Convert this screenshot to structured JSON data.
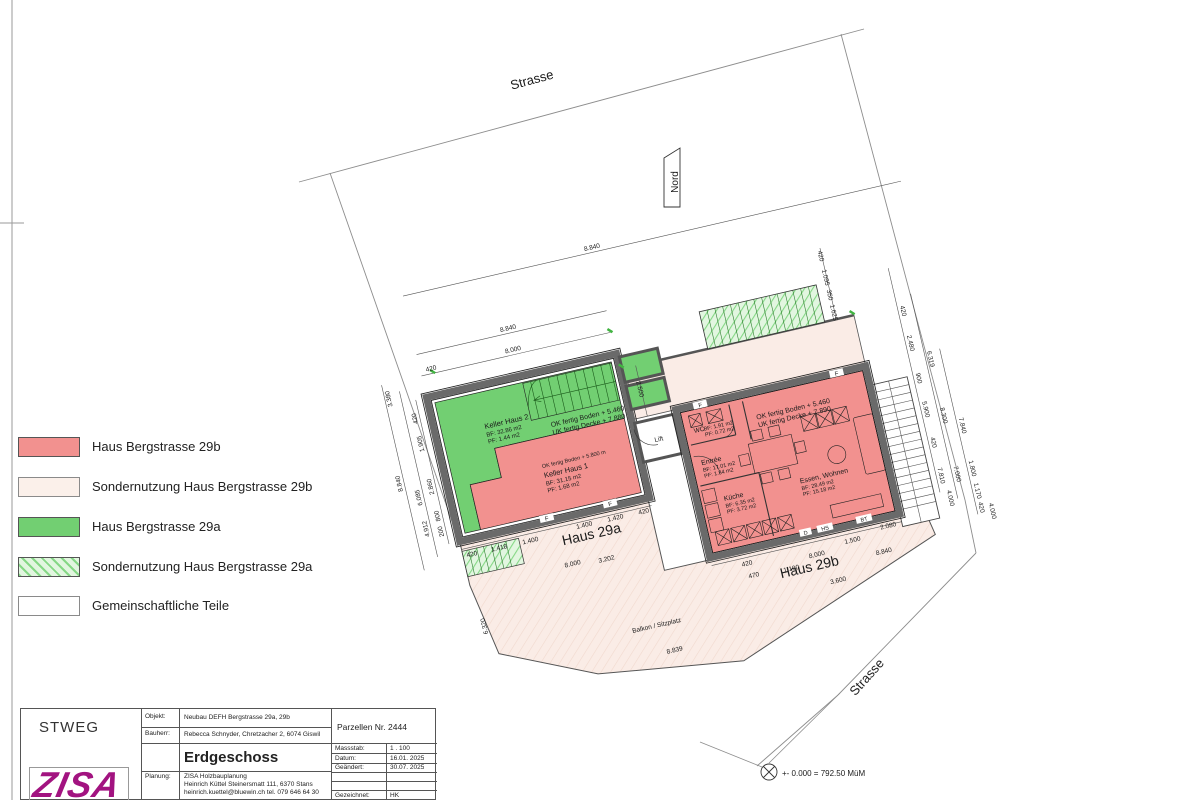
{
  "legend": {
    "items": [
      {
        "label": "Haus  Bergstrasse 29b"
      },
      {
        "label": "Sondernutzung Haus  Bergstrasse 29b"
      },
      {
        "label": "Haus  Bergstrasse 29a"
      },
      {
        "label": "Sondernutzung Haus Bergstrasse 29a"
      },
      {
        "label": "Gemeinschaftliche Teile"
      }
    ]
  },
  "titleblock": {
    "org": "STWEG",
    "logo": "ZISA",
    "objekt_label": "Objekt:",
    "objekt": "Neubau DEFH Bergstrasse 29a, 29b",
    "bauherr_label": "Bauherr:",
    "bauherr": "Rebecca Schnyder,   Chretzacher 2,   6074 Giswil",
    "plan_title": "Erdgeschoss",
    "parzelle": "Parzellen Nr. 2444",
    "massstab_label": "Massstab:",
    "massstab": "1 . 100",
    "datum_label": "Datum:",
    "datum": "16.01. 2025",
    "geaendert_label": "Geändert:",
    "geaendert": "30.07. 2025",
    "gezeichnet_label": "Gezeichnet:",
    "gezeichnet": "HK",
    "planung_label": "Planung:",
    "planung1": "ZISA Holzbauplanung",
    "planung2": "Heinrich Küttel Steinersmatt 111,   6370 Stans",
    "planung3": "heinrich.kuettel@bluewin.ch   tel. 079 646 64 30"
  },
  "plan": {
    "street_top": "Strasse",
    "street_right": "Strasse",
    "north": "Nord",
    "haus_a": "Haus 29a",
    "haus_b": "Haus 29b",
    "level_marker": "+- 0.000 = 792.50 MüM",
    "balkon": "Balkon / Sitzplatz",
    "lift": "Lift",
    "rooms": {
      "keller2": {
        "name": "Keller Haus 2",
        "bf": "BF: 32.86 m2",
        "pf": "PF:   1.44 m2"
      },
      "keller1": {
        "name": "Keller Haus 1",
        "bf": "BF: 31.15 m2",
        "pf": "PF:   1.68 m2",
        "ok": "OK fertig Boden + 5.800 m"
      },
      "levels_a1": "OK fertig Boden  + 5.460",
      "levels_a2": "UK fertig Decke   + 7.880",
      "levels_b1": "OK fertig Boden  + 5.460",
      "levels_b2": "UK fertig Decke   + 7.890",
      "wc": {
        "name": "WC",
        "bf": "BF: 1.91 m2",
        "pf": "PF: 0.72 m2"
      },
      "entree": {
        "name": "Entrée",
        "bf": "BF: 17.01 m2",
        "pf": "PF:   1.84 m2"
      },
      "kueche": {
        "name": "Küche",
        "bf": "BF: 6.35 m2",
        "pf": "PF: 3.72 m2"
      },
      "essen": {
        "name": "Essen, Wohnen",
        "bf": "BF: 28.49 m2",
        "pf": "PF: 15.18 m2"
      }
    },
    "dims": [
      "8.840",
      "420",
      "8.000",
      "8.840",
      "3.380",
      "420",
      "1.905",
      "2.860",
      "800",
      "200",
      "6.085",
      "4.912",
      "8.840",
      "6.320",
      "420",
      "1.418",
      "1.400",
      "1.400",
      "1.420",
      "420",
      "8.000",
      "3.202",
      "420",
      "470",
      "8.000",
      "1.190",
      "1.500",
      "2.080",
      "8.840",
      "3.600",
      "8.839",
      "420",
      "2.480",
      "900",
      "5.900",
      "420",
      "7.810",
      "6.319",
      "8.300",
      "7.000",
      "7.840",
      "1.800",
      "1.170",
      "420",
      "4.000",
      "4.000",
      "2.500",
      "420",
      "1.095",
      "350",
      "1.625"
    ],
    "letters": [
      "F",
      "F",
      "F",
      "F",
      "D",
      "HS",
      "BT"
    ]
  }
}
